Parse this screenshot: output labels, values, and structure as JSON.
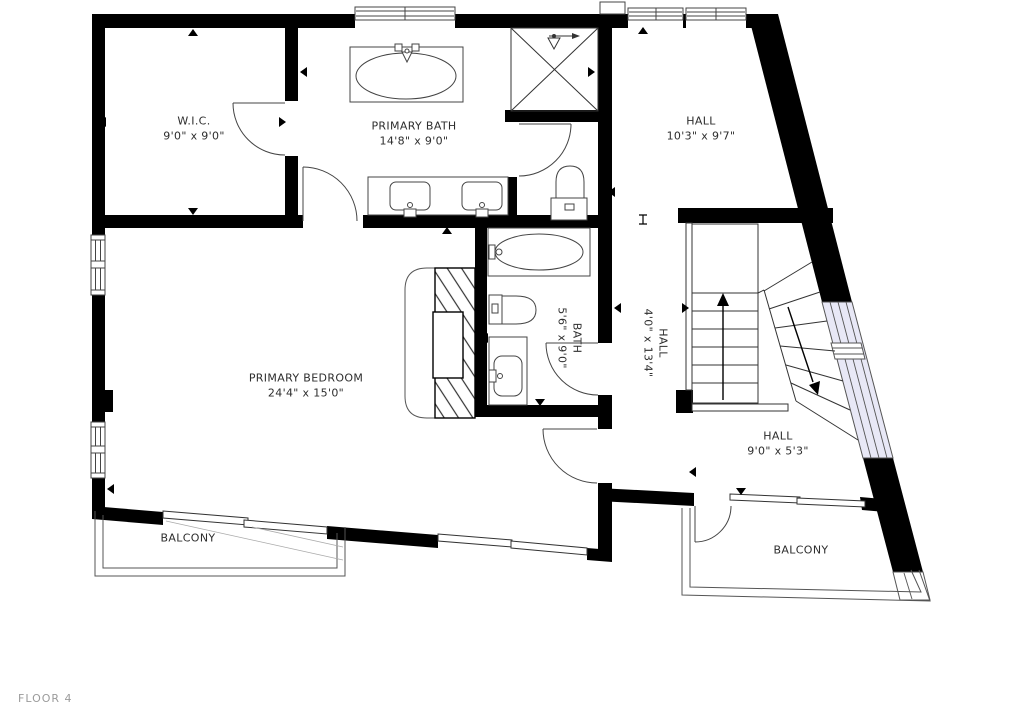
{
  "floor_label": "FLOOR 4",
  "rooms": {
    "wic": {
      "name": "W.I.C.",
      "dims": "9'0\" x 9'0\""
    },
    "primary_bath": {
      "name": "PRIMARY BATH",
      "dims": "14'8\" x 9'0\""
    },
    "hall_upper": {
      "name": "HALL",
      "dims": "10'3\" x 9'7\""
    },
    "primary_bedroom": {
      "name": "PRIMARY BEDROOM",
      "dims": "24'4\" x 15'0\""
    },
    "bath": {
      "name": "BATH",
      "dims": "5'6\" x 9'0\""
    },
    "hall_mid": {
      "name": "HALL",
      "dims": "4'0\" x 13'4\""
    },
    "hall_lower": {
      "name": "HALL",
      "dims": "9'0\" x 5'3\""
    },
    "balcony_left": {
      "name": "BALCONY"
    },
    "balcony_right": {
      "name": "BALCONY"
    }
  },
  "icons": {
    "stairs_up_arrow": "up-arrow",
    "stairs_down_arrow": "down-arrow",
    "shower": "crossed-square",
    "dimension_marker": "small-triangle"
  },
  "colors": {
    "wall": "#000000",
    "fixture_line": "#444444",
    "thin_line": "#555555",
    "window_glass": "#e8e8f6",
    "label_text": "#2d2d2d",
    "floor_label_text": "#9b9b9b"
  }
}
